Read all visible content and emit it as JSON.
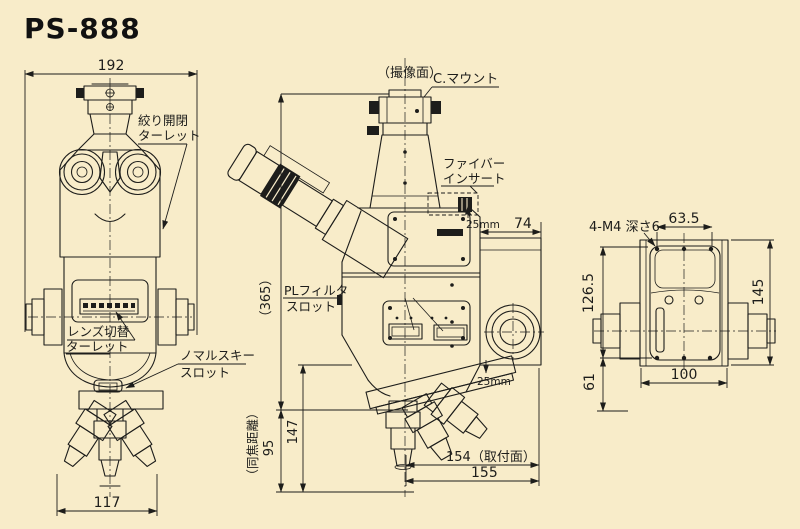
{
  "title": "PS-888",
  "colors": {
    "background": "#f8ecc9",
    "line": "#1d1d1b"
  },
  "front_view": {
    "dim_width": "192",
    "dim_base_width": "117",
    "label_aperture_turret_line1": "絞り開閉",
    "label_aperture_turret_line2": "ターレット",
    "label_lens_turret_line1": "レンズ切替",
    "label_lens_turret_line2": "ターレット",
    "label_nomarski_line1": "ノマルスキー",
    "label_nomarski_line2": "スロット"
  },
  "side_view": {
    "label_imaging_plane": "（撮像面）",
    "label_c_mount": "C.マウント",
    "label_fiber_line1": "ファイバー",
    "label_fiber_line2": "インサート",
    "label_pl_filter_line1": "PLフィルタ",
    "label_pl_filter_line2": "スロット",
    "dim_25mm_top": "25mm",
    "dim_25mm_bottom": "25mm",
    "dim_rear_depth": "74",
    "dim_overall_height": "（365）",
    "dim_147": "147",
    "label_parfocal_distance": "（同焦距離）",
    "dim_parfocal": "95",
    "dim_154": "154（取付面）",
    "dim_155": "155"
  },
  "rear_view": {
    "label_mount_holes": "4-M4 深さ6",
    "dim_63_5": "63.5",
    "dim_126_5": "126.5",
    "dim_61": "61",
    "dim_145": "145",
    "dim_100": "100"
  }
}
